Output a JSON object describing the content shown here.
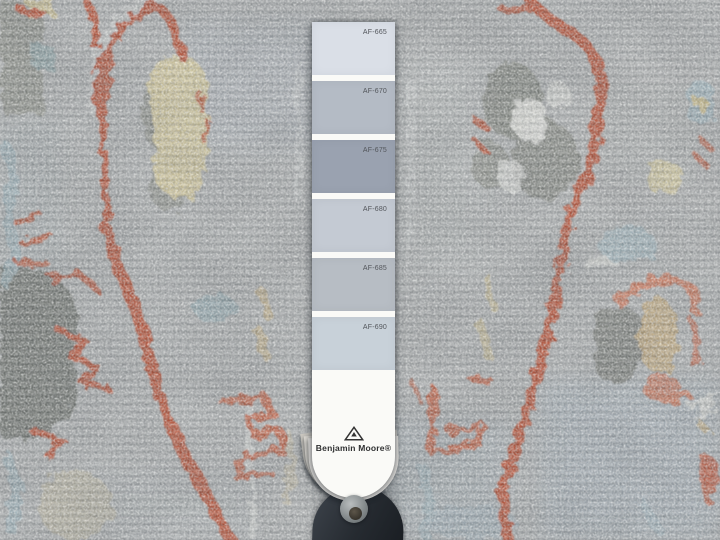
{
  "strip": {
    "swatches": [
      {
        "label": "AF-665",
        "hex": "#dadfe7"
      },
      {
        "label": "AF-670",
        "hex": "#b4bbc5"
      },
      {
        "label": "AF-675",
        "hex": "#9aa2b0"
      },
      {
        "label": "AF-680",
        "hex": "#c4cad3"
      },
      {
        "label": "AF-685",
        "hex": "#b7bdc4"
      },
      {
        "label": "AF-690",
        "hex": "#c8d1d9"
      }
    ],
    "brand": "Benjamin Moore®",
    "logo_icon": "benjamin-moore-triangle-icon"
  },
  "fan_deck": {
    "cover_color": "#272c33",
    "grommet_color": "#81888b"
  },
  "rug": {
    "base_color": "#b1b4b5",
    "accent_colors": {
      "rust_red": "#bd5134",
      "salmon": "#cf7b61",
      "pale_yellow": "#dbcf9f",
      "slate_gray": "#757872",
      "light_blue": "#9db6c0",
      "tan": "#c9b285"
    }
  }
}
